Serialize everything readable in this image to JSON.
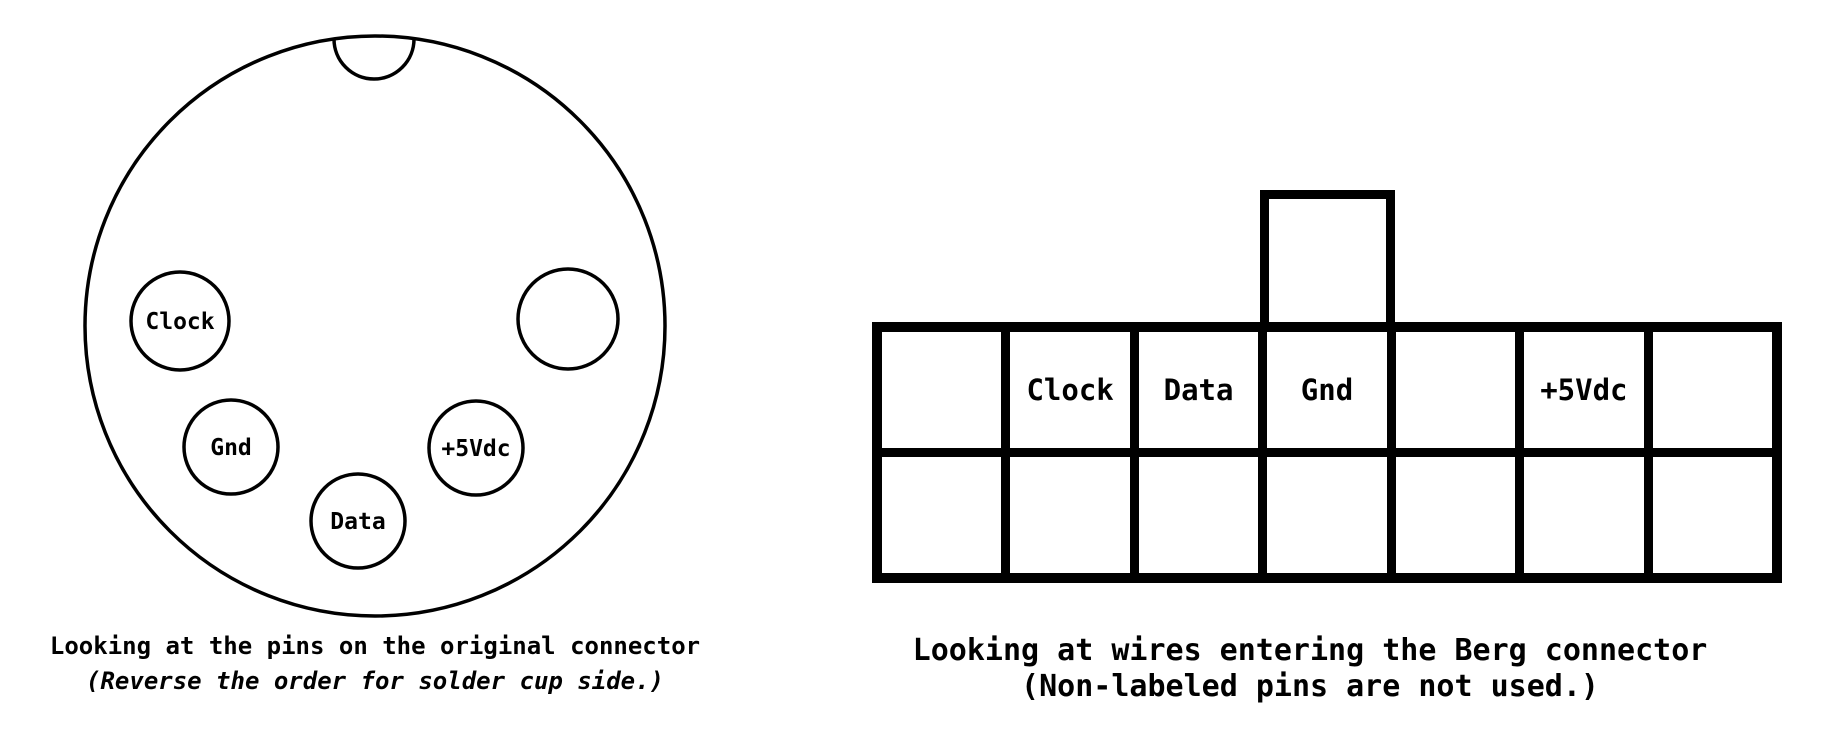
{
  "colors": {
    "background": "#ffffff",
    "ink": "#000000"
  },
  "din_connector": {
    "pins": [
      {
        "id": "clock",
        "label": "Clock"
      },
      {
        "id": "unlabeled",
        "label": ""
      },
      {
        "id": "gnd",
        "label": "Gnd"
      },
      {
        "id": "plus5vdc",
        "label": "+5Vdc"
      },
      {
        "id": "data",
        "label": "Data"
      }
    ],
    "caption_line1": "Looking at the pins on the original connector",
    "caption_line2": "(Reverse the order for solder cup side.)"
  },
  "berg_connector": {
    "row1_cells": [
      "",
      "Clock",
      "Data",
      "Gnd",
      "",
      "+5Vdc",
      ""
    ],
    "row2_cells": [
      "",
      "",
      "",
      "",
      "",
      "",
      ""
    ],
    "caption_line1": "Looking at wires entering the Berg connector",
    "caption_line2": "(Non-labeled pins are not used.)"
  }
}
